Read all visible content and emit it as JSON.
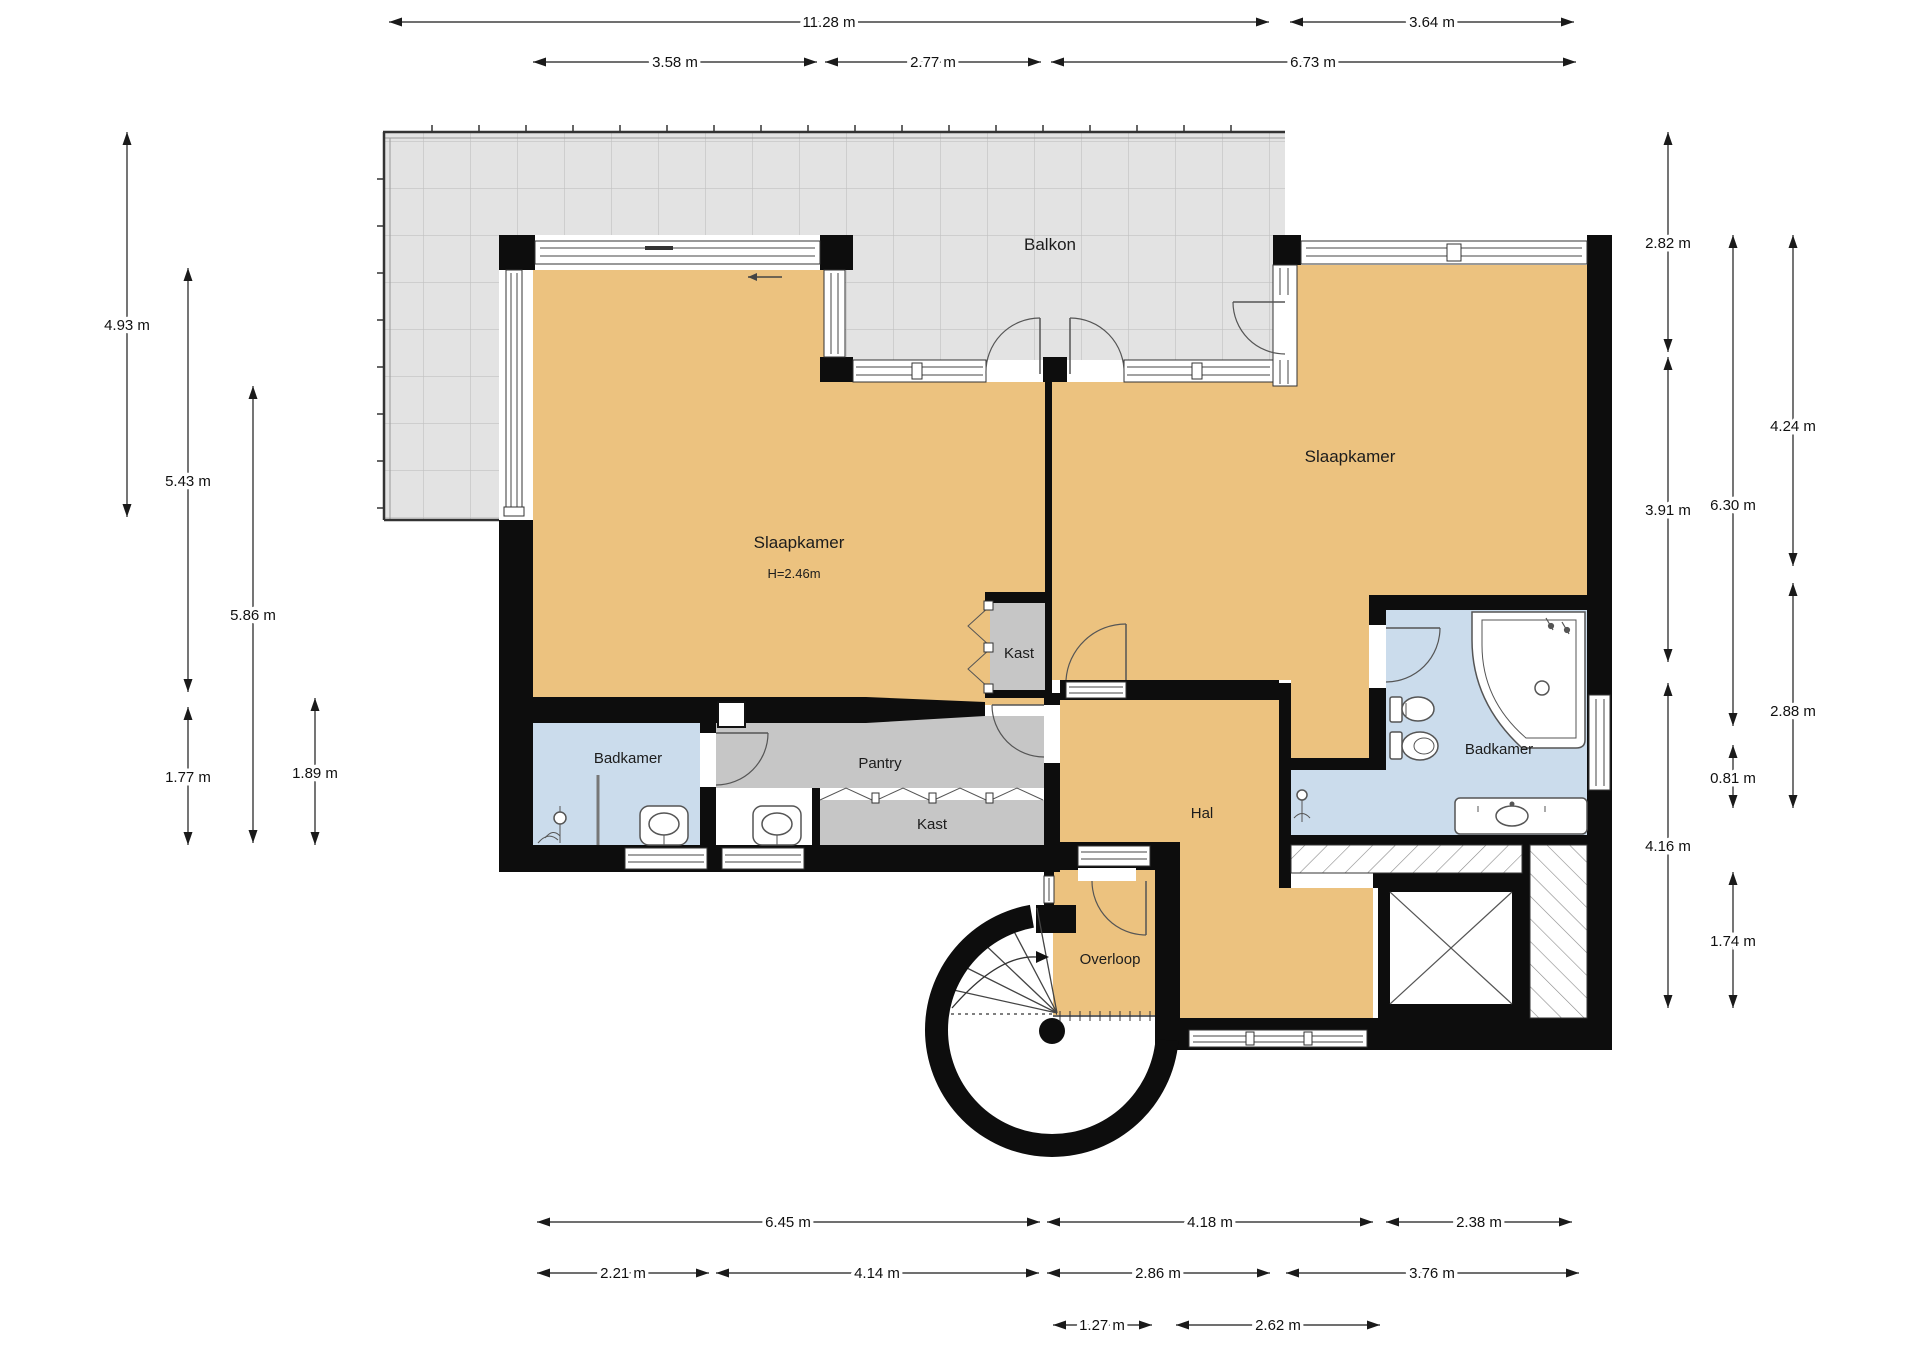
{
  "plan_type": "floor-plan",
  "rooms": {
    "balkon": {
      "label": "Balkon"
    },
    "slaapkamer_left": {
      "label": "Slaapkamer",
      "ceiling_height": "H=2.46m"
    },
    "slaapkamer_right": {
      "label": "Slaapkamer"
    },
    "badkamer_left": {
      "label": "Badkamer"
    },
    "badkamer_right": {
      "label": "Badkamer"
    },
    "pantry": {
      "label": "Pantry"
    },
    "kast_upper": {
      "label": "Kast"
    },
    "kast_lower": {
      "label": "Kast"
    },
    "hal": {
      "label": "Hal"
    },
    "overloop": {
      "label": "Overloop"
    }
  },
  "dimensions": {
    "top_row_outer": [
      "11.28 m",
      "3.64 m"
    ],
    "top_row_inner": [
      "3.58 m",
      "2.77 m",
      "6.73 m"
    ],
    "left_column": [
      "4.93 m",
      "5.43 m",
      "5.86 m",
      "1.77 m",
      "1.89 m"
    ],
    "right_column": [
      "2.82 m",
      "3.91 m",
      "4.16 m",
      "6.30 m",
      "0.81 m",
      "1.74 m",
      "4.24 m",
      "2.88 m"
    ],
    "bottom_row_1": [
      "6.45 m",
      "4.18 m",
      "2.38 m"
    ],
    "bottom_row_2": [
      "2.21 m",
      "4.14 m",
      "2.86 m",
      "3.76 m"
    ],
    "bottom_row_3": [
      "1.27 m",
      "2.62 m"
    ]
  },
  "colors": {
    "wall": "#0d0d0d",
    "room_orange": "#ecc27f",
    "bathroom_blue": "#cbdcec",
    "closet_grey": "#c6c6c6",
    "balcony_grey": "#e3e3e3"
  }
}
